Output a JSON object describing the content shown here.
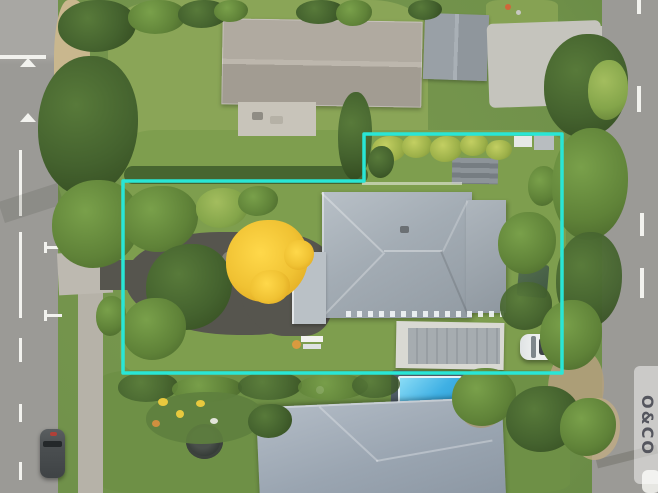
{
  "image": {
    "type": "aerial-drone-photograph",
    "subject": "residential property for sale with highlighted lot boundary, houses, roads, trees and pool",
    "watermark": {
      "text": "O&CO"
    }
  },
  "boundary": {
    "points": "364,134 562,134 562,373 123,373 123,181 364,181",
    "color": "#29e6d6"
  },
  "colors": {
    "grass": "#7b9a50",
    "lawn_top": "#8aa557",
    "road": "#9b9a96",
    "road_light": "#a8a7a3",
    "asphalt": "#56554e",
    "sidewalk": "#b6b2a8",
    "apron": "#bdb9b0",
    "sand": "#c9b78e",
    "concrete": "#c5c4bd",
    "roof_main_hi": "#b8c0c7",
    "roof_main_lo": "#929ba3",
    "roof_top_neighbor": "#aca69c",
    "roof_bottom_neighbor": "#9aa5b1",
    "garage_roof": "#a3a9ae",
    "pool_water": "#3fb0e4",
    "pool_deck": "#4e5a64",
    "yellow_tree": "#f0c233",
    "shed_green": "#4a614c",
    "car_white": "#eef0f0",
    "car_dark": "#4a4e50",
    "dirt": "#b2a07c",
    "marking": "#f2f2ee",
    "watermark_text": "#55565e",
    "boundary": "#29e6d6"
  }
}
